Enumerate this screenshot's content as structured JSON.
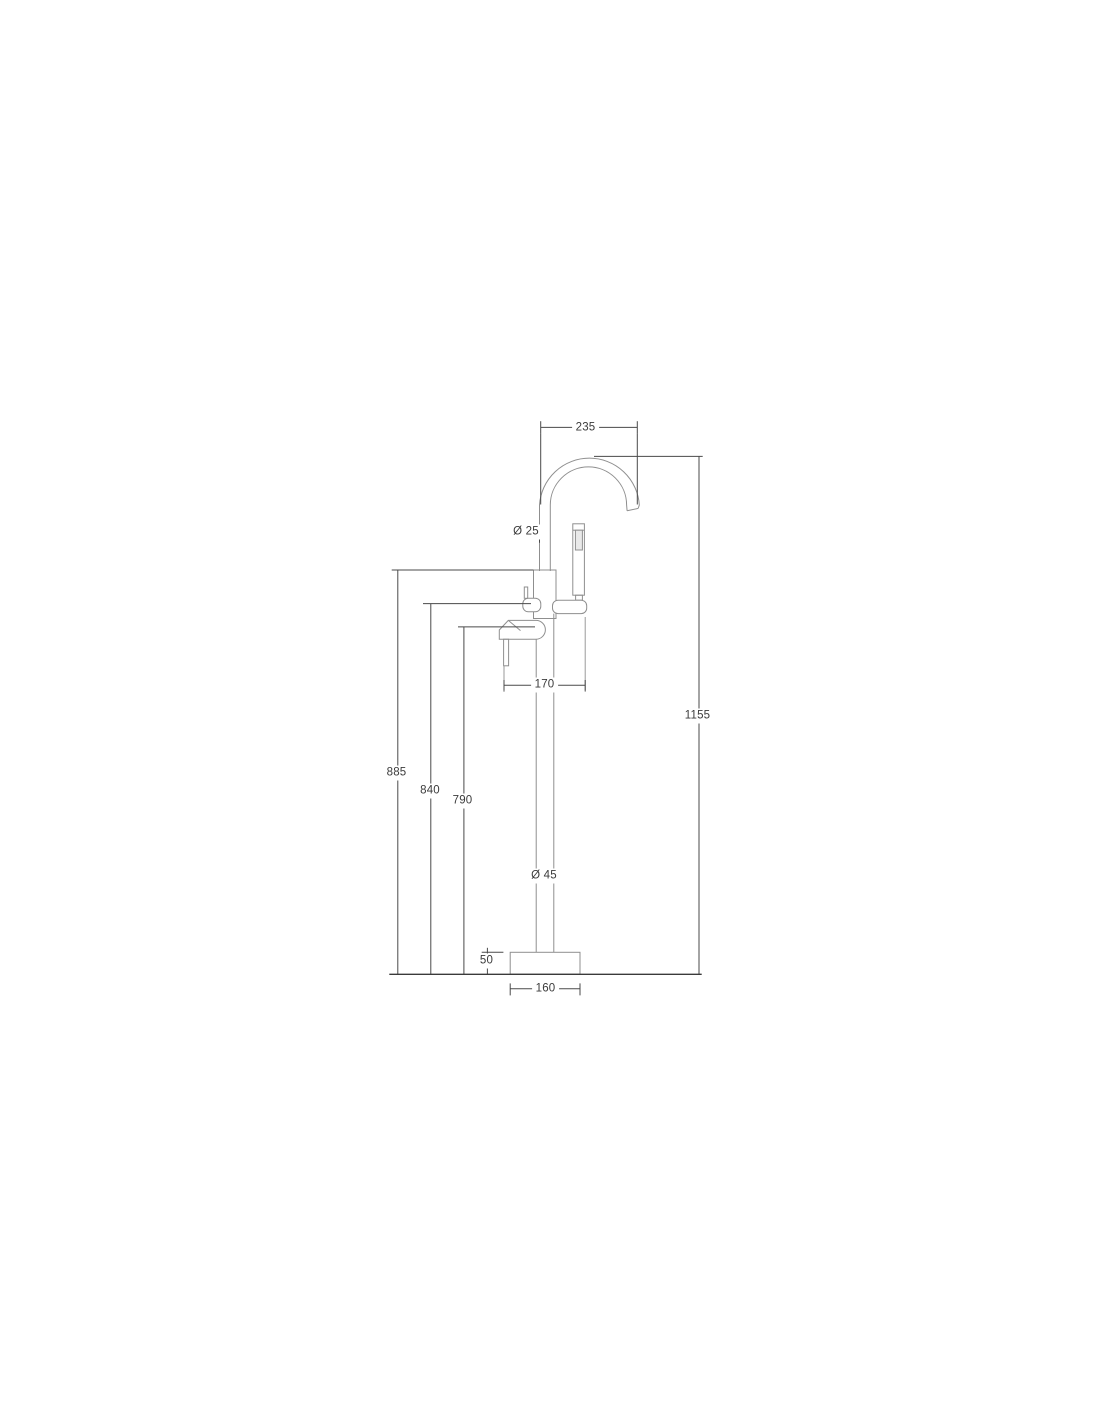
{
  "drawing": {
    "colors": {
      "background": "#ffffff",
      "product_outline": "#8f8f8f",
      "dimension_lines": "#4a4a4a",
      "label_text": "#3b3b3b"
    },
    "dimensions": {
      "spout_width": "235",
      "spout_pipe_diameter": "Ø 25",
      "handle_spread": "170",
      "total_height": "1155",
      "spout_base_height": "885",
      "diverter_height": "840",
      "handle_height": "790",
      "column_diameter": "Ø 45",
      "base_plate_height": "50",
      "base_plate_width": "160"
    }
  }
}
